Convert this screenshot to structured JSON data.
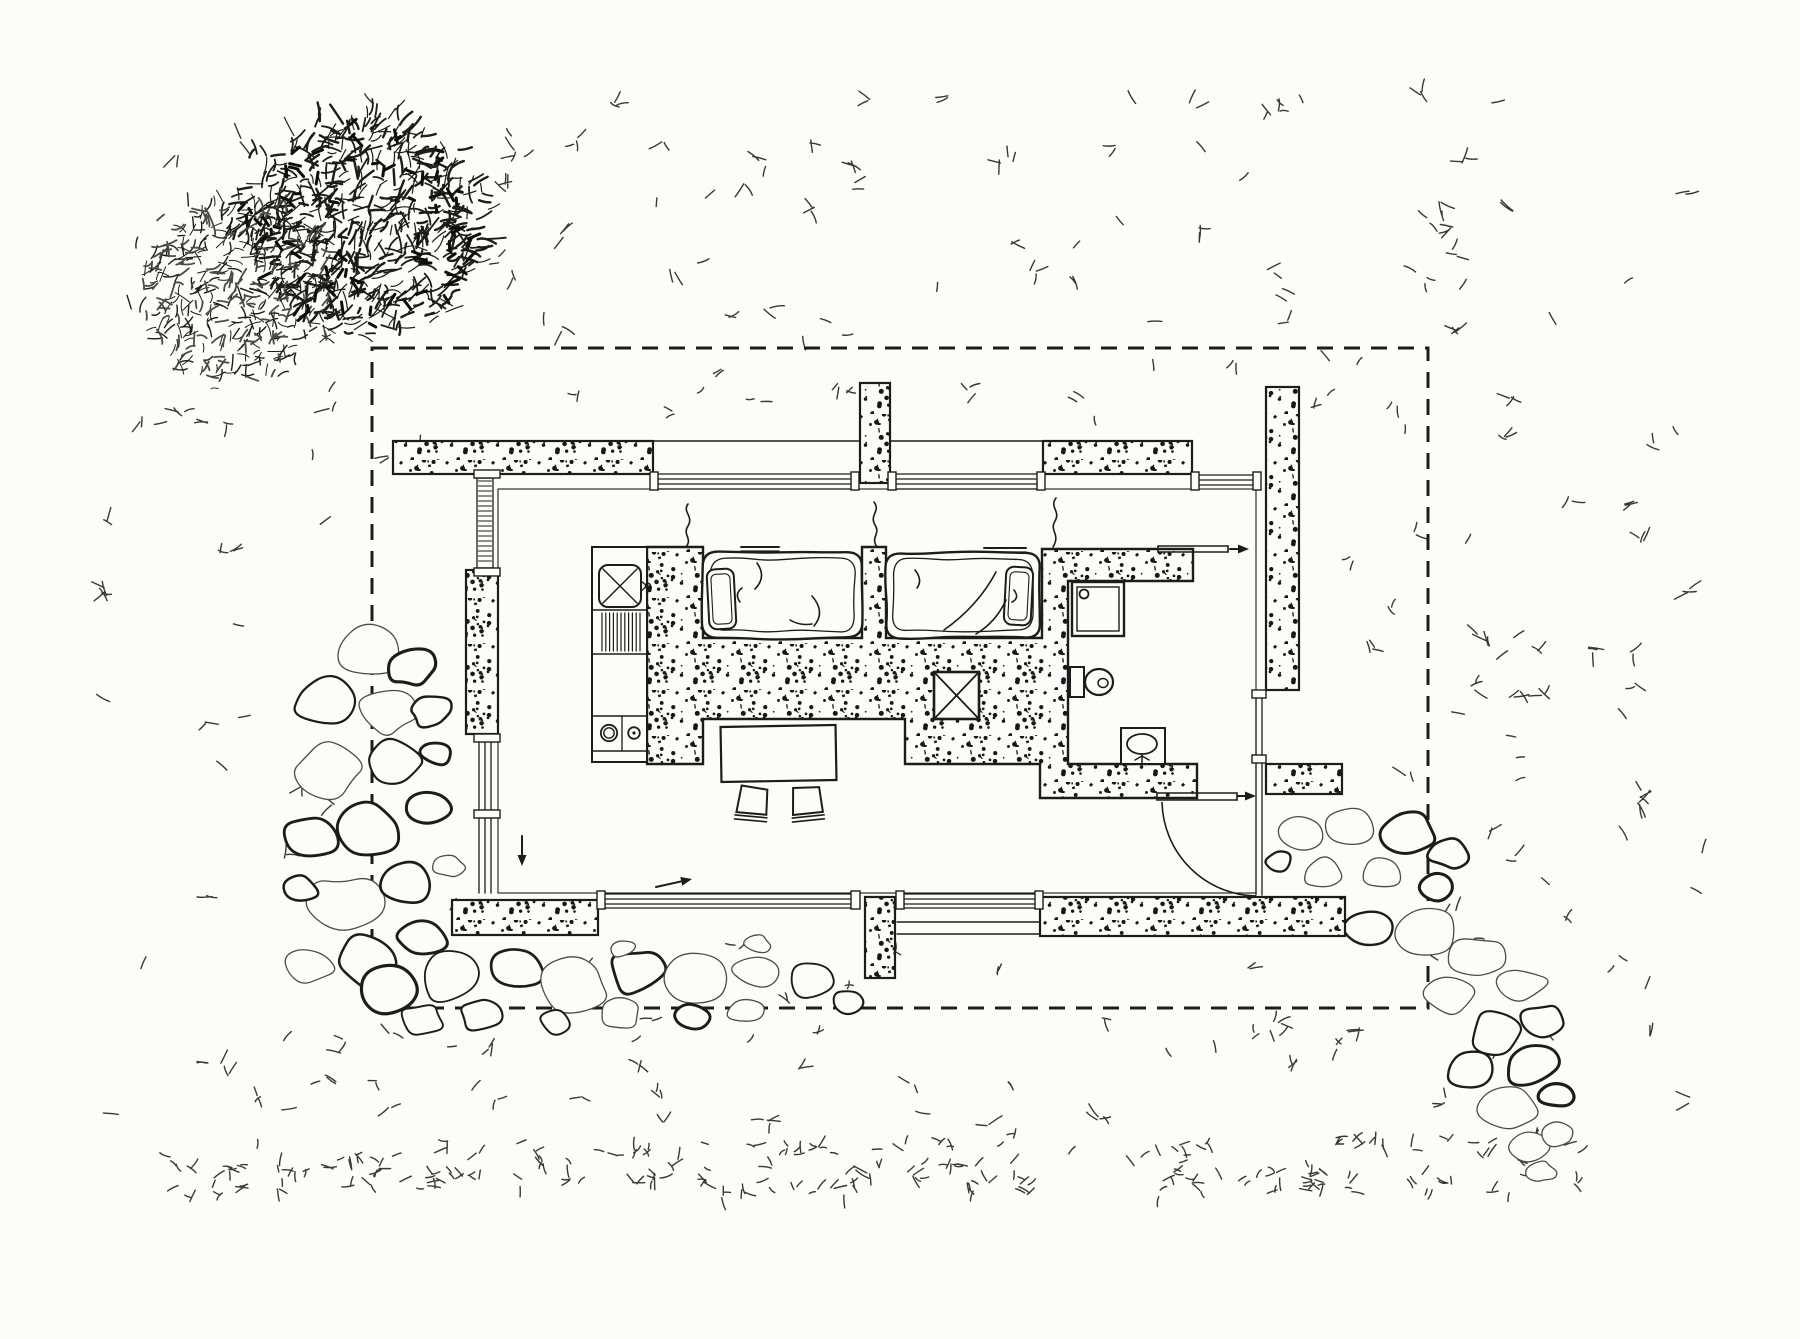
{
  "meta": {
    "canvas": {
      "w": 1800,
      "h": 1339
    },
    "colors": {
      "paper": "#fcfcfa",
      "ink": "#1c1c1c",
      "ink_soft": "#4a4a4a",
      "speck": "#171717"
    },
    "texture_seed": 11
  },
  "boundary": {
    "name": "property-boundary",
    "x": 372,
    "y": 348,
    "w": 1056,
    "h": 660,
    "dash": [
      16,
      11
    ],
    "stroke_w": 3
  },
  "tree": {
    "name": "tree-canopy",
    "lobes": [
      {
        "cx": 360,
        "cy": 225,
        "rx": 128,
        "ry": 110,
        "count": 640,
        "w_min": 1.2,
        "w_max": 2.4,
        "len_min": 8,
        "len_max": 20,
        "soft": 0.12
      },
      {
        "cx": 232,
        "cy": 292,
        "rx": 102,
        "ry": 92,
        "count": 400,
        "w_min": 1.0,
        "w_max": 1.8,
        "len_min": 7,
        "len_max": 16,
        "soft": 0.45
      }
    ],
    "clump_count": 80
  },
  "grass": {
    "name": "grass-texture",
    "avoid_rect": [
      462,
      432,
      1352,
      942
    ],
    "zones": [
      {
        "x": 95,
        "y": 85,
        "w": 1610,
        "h": 1170,
        "count": 120,
        "len": [
          8,
          16
        ]
      },
      {
        "x": 150,
        "y": 1140,
        "w": 1430,
        "h": 55,
        "count": 155,
        "len": [
          6,
          13
        ]
      },
      {
        "x": 460,
        "y": 95,
        "w": 1050,
        "h": 240,
        "count": 48,
        "len": [
          8,
          15
        ]
      },
      {
        "x": 200,
        "y": 1020,
        "w": 1300,
        "h": 115,
        "count": 30,
        "len": [
          7,
          13
        ]
      },
      {
        "x": 1440,
        "y": 360,
        "w": 250,
        "h": 720,
        "count": 30,
        "len": [
          8,
          15
        ]
      },
      {
        "x": 95,
        "y": 380,
        "w": 255,
        "h": 740,
        "count": 26,
        "len": [
          8,
          15
        ]
      },
      {
        "x": 400,
        "y": 356,
        "w": 1000,
        "h": 70,
        "count": 14,
        "len": [
          7,
          12
        ]
      },
      {
        "x": 1305,
        "y": 400,
        "w": 115,
        "h": 360,
        "count": 10,
        "len": [
          7,
          12
        ]
      },
      {
        "x": 520,
        "y": 945,
        "w": 500,
        "h": 55,
        "count": 6,
        "len": [
          6,
          10
        ]
      }
    ]
  },
  "walls": {
    "name": "exterior-walls",
    "stippled_segments": [
      {
        "name": "wall-top-left",
        "x": 393,
        "y": 441,
        "w": 260,
        "h": 33
      },
      {
        "name": "wall-top-right",
        "x": 1043,
        "y": 441,
        "w": 149,
        "h": 33
      },
      {
        "name": "pier-top",
        "x": 860,
        "y": 383,
        "w": 30,
        "h": 100
      },
      {
        "name": "wall-right",
        "x": 1266,
        "y": 387,
        "w": 33,
        "h": 303
      },
      {
        "name": "wall-right-lower",
        "x": 1266,
        "y": 764,
        "w": 76,
        "h": 30
      },
      {
        "name": "wall-left-mid",
        "x": 466,
        "y": 570,
        "w": 32,
        "h": 164
      },
      {
        "name": "wall-bottom-left",
        "x": 452,
        "y": 900,
        "w": 146,
        "h": 35
      },
      {
        "name": "wall-bottom-right",
        "x": 1040,
        "y": 897,
        "w": 305,
        "h": 39
      },
      {
        "name": "pier-bottom",
        "x": 865,
        "y": 897,
        "w": 30,
        "h": 81
      }
    ],
    "partition_path": "M647,547 H703 V638 H862 V547 H886 V638 H1042 V549 H1193 V581 H1068 V764 H1197 V798 H1040 V764 H905 V719 H703 V764 H647 Z",
    "floor_rect": {
      "x": 498,
      "y": 489,
      "w": 758,
      "h": 404
    },
    "lines": [
      {
        "x1": 393,
        "y1": 441,
        "x2": 1192,
        "y2": 441,
        "w": 1.6
      },
      {
        "x1": 498,
        "y1": 489,
        "x2": 1256,
        "y2": 489,
        "w": 1.1
      },
      {
        "x1": 897,
        "y1": 922,
        "x2": 1040,
        "y2": 922,
        "w": 1.4
      },
      {
        "x1": 897,
        "y1": 934,
        "x2": 1040,
        "y2": 934,
        "w": 1.4
      }
    ],
    "glazing_h": [
      {
        "name": "window-top-a",
        "x1": 655,
        "x2": 852,
        "ys": [
          474,
          479,
          484,
          489
        ]
      },
      {
        "name": "window-top-b",
        "x1": 894,
        "x2": 1038,
        "ys": [
          474,
          479,
          484,
          489
        ]
      },
      {
        "name": "window-top-c",
        "x1": 1194,
        "x2": 1256,
        "ys": [
          475,
          480,
          485
        ]
      },
      {
        "name": "window-bottom-a",
        "x1": 604,
        "x2": 852,
        "ys": [
          894,
          899,
          904,
          908
        ]
      },
      {
        "name": "window-bottom-b",
        "x1": 898,
        "x2": 1036,
        "ys": [
          894,
          899,
          904,
          908
        ]
      }
    ],
    "glazing_v": [
      {
        "name": "window-right-door",
        "y1": 690,
        "y2": 895,
        "xs": [
          1256,
          1262
        ]
      },
      {
        "name": "window-left-lower",
        "y1": 737,
        "y2": 893,
        "xs": [
          479,
          485,
          491
        ]
      }
    ],
    "hatch_window": {
      "name": "window-left-upper",
      "x": 477,
      "y": 478,
      "w": 16,
      "h": 90,
      "step": 5
    },
    "mullions": [
      [
        650,
        472,
        8,
        18
      ],
      [
        851,
        472,
        8,
        18
      ],
      [
        888,
        472,
        8,
        18
      ],
      [
        1037,
        472,
        8,
        18
      ],
      [
        1191,
        472,
        8,
        18
      ],
      [
        1253,
        472,
        8,
        18
      ],
      [
        597,
        891,
        8,
        18
      ],
      [
        851,
        891,
        9,
        18
      ],
      [
        896,
        891,
        8,
        18
      ],
      [
        1035,
        891,
        8,
        18
      ],
      [
        474,
        734,
        26,
        8
      ],
      [
        474,
        810,
        26,
        8
      ],
      [
        474,
        568,
        26,
        8
      ],
      [
        474,
        470,
        26,
        8
      ],
      [
        1252,
        690,
        14,
        8
      ],
      [
        1252,
        755,
        14,
        8
      ]
    ]
  },
  "chimney": {
    "name": "chimney-flue",
    "x": 934,
    "y": 672,
    "w": 45,
    "h": 47
  },
  "kitchen": {
    "name": "kitchen-counter",
    "counter": {
      "x": 592,
      "y": 547,
      "w": 55,
      "h": 215
    },
    "dividers_y": [
      610,
      654,
      716,
      751
    ],
    "sink": {
      "name": "kitchen-sink",
      "x": 599,
      "y": 565,
      "w": 42,
      "h": 42,
      "r": 9,
      "faucet_cx": 648,
      "faucet_cy": 586
    },
    "drainboard": {
      "x1": 602,
      "x2": 641,
      "y1": 613,
      "y2": 651,
      "step": 3.8
    },
    "burners": {
      "name": "stove-burners",
      "divider_x": 622,
      "b1": {
        "cx": 609,
        "cy": 733,
        "r1": 8.2,
        "r2": 5.2
      },
      "b2": {
        "cx": 634,
        "cy": 733,
        "r1": 5.8,
        "r2": 1.6
      }
    }
  },
  "beds": [
    {
      "name": "bed-1",
      "x": 703,
      "y": 552,
      "w": 159,
      "h": 86,
      "pillow": {
        "x": 708,
        "y": 569,
        "w": 27,
        "h": 60,
        "rot": -3
      },
      "folds": [
        "M757,563 q10,14 -2,26",
        "M812,596 q14,16 2,30",
        "M742,588 q-8,6 -2,14",
        "M790,620 q10,6 22,4"
      ],
      "shelf": {
        "x": 741,
        "y": 547,
        "w": 38
      }
    },
    {
      "name": "bed-2",
      "x": 886,
      "y": 553,
      "w": 154,
      "h": 85,
      "pillow": {
        "x": 1005,
        "y": 567,
        "w": 27,
        "h": 58,
        "rot": 3
      },
      "folds": [
        "M996,572 q-18,34 -52,58",
        "M1006,600 q-10,22 -30,34",
        "M915,570 q8,10 2,18",
        "M1014,590 q6,8 -2,12"
      ],
      "shelf": {
        "x": 984,
        "y": 548,
        "w": 42
      }
    }
  ],
  "bath": {
    "name": "bathroom",
    "shower": {
      "name": "shower",
      "x": 1072,
      "y": 582,
      "w": 52,
      "h": 54,
      "inset": 5,
      "drain": {
        "cx": 1084,
        "cy": 594,
        "r": 4.5
      }
    },
    "toilet": {
      "name": "toilet",
      "tank": {
        "x": 1070,
        "y": 667,
        "w": 14,
        "h": 30
      },
      "bowl": {
        "cx": 1099,
        "cy": 682,
        "rx": 14,
        "ry": 13
      },
      "inner": {
        "cx": 1103,
        "cy": 683,
        "rx": 5,
        "ry": 4.5
      }
    },
    "sink": {
      "name": "bathroom-sink",
      "box": {
        "x": 1121,
        "y": 728,
        "w": 44,
        "h": 36
      },
      "basin": {
        "cx": 1142,
        "cy": 744,
        "rx": 15,
        "ry": 10
      },
      "faucet": [
        "M1142,755 L1142,764",
        "M1135,760 L1142,756",
        "M1149,760 L1142,756"
      ]
    }
  },
  "furniture": {
    "table": {
      "name": "dining-table",
      "x": 721,
      "y": 726,
      "w": 115,
      "h": 55,
      "rot": -1
    },
    "stools": [
      {
        "name": "stool-left",
        "x": 738,
        "y": 787,
        "w": 30,
        "h": 26,
        "rot": 7
      },
      {
        "name": "stool-right",
        "x": 792,
        "y": 787,
        "w": 30,
        "h": 26,
        "rot": -4
      }
    ]
  },
  "doors": {
    "leaf_bars": [
      {
        "name": "bathroom-sliding-door-leaf",
        "x1": 1158,
        "x2": 1228,
        "y": 546,
        "gap": 6
      },
      {
        "name": "entry-door-leaf",
        "x1": 1157,
        "x2": 1237,
        "y": 793,
        "gap": 7
      }
    ],
    "swing_arc": {
      "name": "entry-door-swing",
      "d": "M1162,802 A96,96 0 0 0 1256,896",
      "w": 1.6
    },
    "arrows": [
      {
        "name": "bathroom-door-arrow",
        "x1": 1230,
        "y1": 549,
        "x2": 1249,
        "y2": 549
      },
      {
        "name": "entry-door-arrow",
        "x1": 1238,
        "y1": 796,
        "x2": 1256,
        "y2": 796
      },
      {
        "name": "slide-direction-arrow",
        "x1": 656,
        "y1": 887,
        "x2": 692,
        "y2": 879
      },
      {
        "name": "left-door-arrow",
        "x1": 522,
        "y1": 836,
        "x2": 522,
        "y2": 866
      }
    ]
  },
  "squiggles": {
    "name": "steam-squiggles",
    "paths": [
      "M688,504 c-6,8 6,12 0,22 c-6,9 5,12 -2,21",
      "M874,502 c7,9 -5,13 1,23 c6,9 -5,12 2,22",
      "M1056,498 c-7,9 5,13 -1,23 c-6,10 6,13 -2,26"
    ]
  },
  "stones": {
    "clusters": [
      {
        "name": "flagstone-paving-left",
        "items": [
          [
            365,
            655,
            36
          ],
          [
            322,
            700,
            30
          ],
          [
            412,
            668,
            26
          ],
          [
            385,
            712,
            28
          ],
          [
            432,
            712,
            20
          ],
          [
            330,
            768,
            36
          ],
          [
            393,
            762,
            27
          ],
          [
            436,
            752,
            18
          ],
          [
            312,
            838,
            28
          ],
          [
            368,
            828,
            34
          ],
          [
            428,
            806,
            24
          ],
          [
            340,
            905,
            38
          ],
          [
            405,
            885,
            28
          ],
          [
            448,
            865,
            16
          ],
          [
            310,
            965,
            24
          ],
          [
            365,
            962,
            32
          ],
          [
            425,
            940,
            26
          ],
          [
            300,
            890,
            18
          ],
          [
            390,
            990,
            30
          ],
          [
            450,
            975,
            34
          ],
          [
            515,
            968,
            30
          ],
          [
            575,
            985,
            32
          ],
          [
            638,
            972,
            30
          ],
          [
            700,
            978,
            32
          ],
          [
            760,
            972,
            28
          ],
          [
            815,
            980,
            26
          ],
          [
            850,
            1002,
            16
          ],
          [
            480,
            1015,
            20
          ],
          [
            555,
            1020,
            18
          ],
          [
            620,
            1013,
            22
          ],
          [
            690,
            1016,
            18
          ],
          [
            745,
            1010,
            20
          ],
          [
            420,
            1020,
            22
          ],
          [
            622,
            948,
            13
          ],
          [
            758,
            944,
            12
          ]
        ]
      },
      {
        "name": "flagstone-paving-right",
        "items": [
          [
            1298,
            832,
            30
          ],
          [
            1352,
            824,
            27
          ],
          [
            1406,
            832,
            28
          ],
          [
            1448,
            852,
            20
          ],
          [
            1322,
            874,
            22
          ],
          [
            1382,
            874,
            22
          ],
          [
            1434,
            888,
            18
          ],
          [
            1278,
            862,
            14
          ],
          [
            1368,
            928,
            24
          ],
          [
            1428,
            932,
            32
          ],
          [
            1478,
            958,
            28
          ],
          [
            1452,
            995,
            26
          ],
          [
            1520,
            985,
            26
          ],
          [
            1498,
            1030,
            30
          ],
          [
            1545,
            1020,
            22
          ],
          [
            1470,
            1068,
            28
          ],
          [
            1530,
            1065,
            26
          ],
          [
            1510,
            1108,
            28
          ],
          [
            1556,
            1095,
            18
          ],
          [
            1528,
            1145,
            22
          ],
          [
            1560,
            1135,
            16
          ],
          [
            1542,
            1172,
            14
          ]
        ]
      }
    ]
  }
}
